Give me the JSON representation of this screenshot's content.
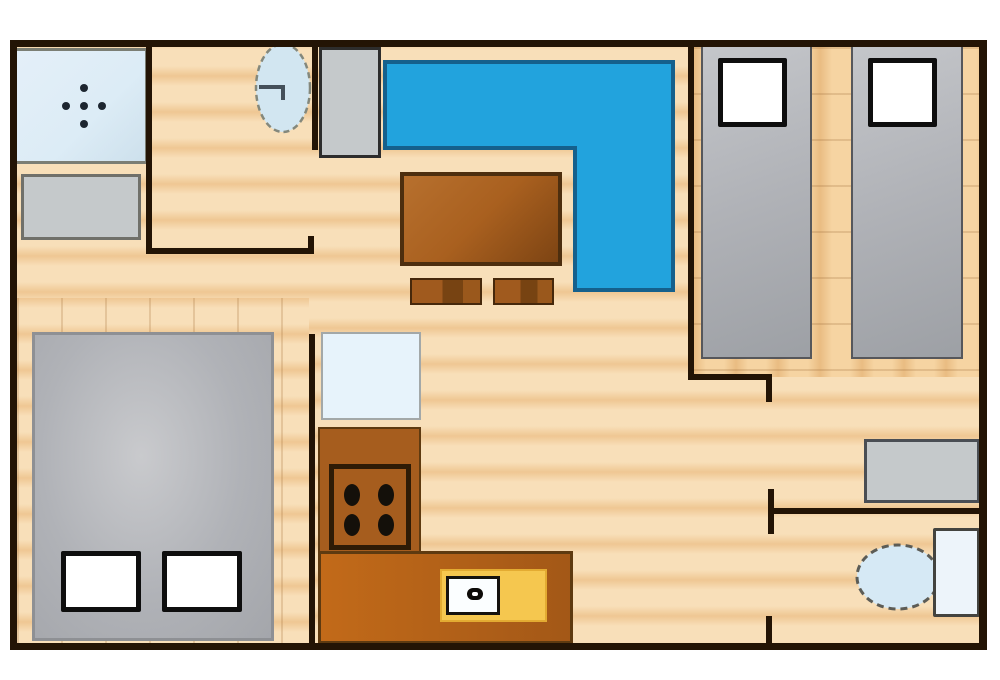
{
  "plan": {
    "kind": "apartment-floor-plan",
    "rooms_visible": 5,
    "furniture": [
      {
        "name": "shower",
        "shape": "light-blue square with five drain dots"
      },
      {
        "name": "washing-machine",
        "shape": "gray rectangle"
      },
      {
        "name": "wash-basin",
        "shape": "dashed light-blue oval with tap"
      },
      {
        "name": "wardrobe-cabinet",
        "shape": "tall gray rectangle"
      },
      {
        "name": "corner-sofa",
        "shape": "blue L-shaped polygon"
      },
      {
        "name": "coffee-table",
        "shape": "brown rectangle"
      },
      {
        "name": "stool-1",
        "shape": "small brown rectangle"
      },
      {
        "name": "stool-2",
        "shape": "small brown rectangle"
      },
      {
        "name": "single-bed-1",
        "shape": "gray rectangle with white pillow"
      },
      {
        "name": "single-bed-2",
        "shape": "gray rectangle with white pillow"
      },
      {
        "name": "double-bed",
        "shape": "large gray rectangle with two white pillows"
      },
      {
        "name": "kitchen-table",
        "shape": "pale blue square"
      },
      {
        "name": "kitchen-counter",
        "shape": "orange-brown L-shaped counter"
      },
      {
        "name": "stove",
        "shape": "dark-bordered square with four burners"
      },
      {
        "name": "kitchen-sink",
        "shape": "yellow platform with white basin and faucet"
      },
      {
        "name": "dresser",
        "shape": "gray rectangle"
      },
      {
        "name": "toilet",
        "shape": "light-blue oval bowl with tank"
      }
    ]
  },
  "colors": {
    "wall": "#231405",
    "floor_light": "#f8dfb9",
    "floor_dark": "#efc793",
    "floor2_light": "#f6d4a2",
    "floor2_dark": "#e9bc82",
    "sofa": "#22a3dd",
    "sofa_border": "#15608c",
    "table_brown": "#a9601f",
    "table_border": "#4d2e0e",
    "counter": "#a65d1e",
    "counter_border": "#5e3a10",
    "stove_border": "#2e1b06",
    "burner": "#14100a",
    "bed_gray": "#b0b2b7",
    "bed_border": "#56575b",
    "pillow_border": "#0e0e0e",
    "appliance_gray": "#c5c9cb",
    "appliance_border": "#70706a",
    "cabinet_border": "#2d2d2d",
    "shower_fill": "#dcecf6",
    "shower_border": "#7b7e74",
    "dot": "#1d2630",
    "basin_fill": "#d2e6f1",
    "basin_border": "#84887c",
    "blue_table": "#e7f3fb",
    "blue_table_border": "#a3a8a8",
    "sink_yellow": "#f5c74f",
    "sink_white": "#fbfeff",
    "sink_border": "#15120e",
    "toilet_fill": "#d6e9f5",
    "toilet_border": "#5c5c56",
    "tank_fill": "#edf4fa",
    "tank_border": "#43433f"
  }
}
